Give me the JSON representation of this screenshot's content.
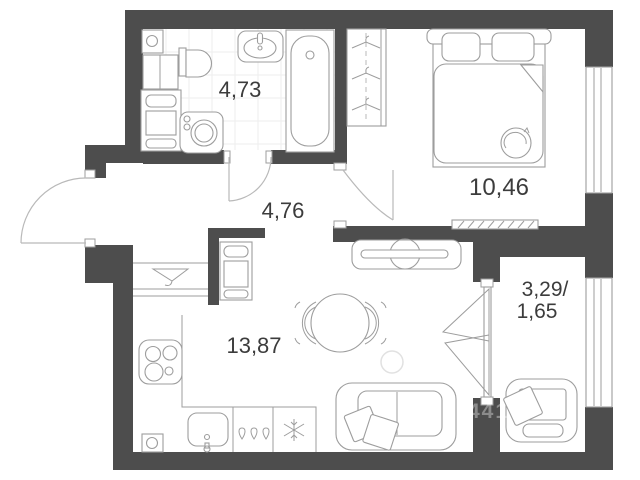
{
  "rooms": {
    "bathroom": {
      "area": "4,73"
    },
    "hallway": {
      "area": "4,76"
    },
    "bedroom": {
      "area": "10,46"
    },
    "living_kitchen": {
      "area": "13,87"
    },
    "balcony": {
      "area_total": "3,29/",
      "area_reduced": "1,65"
    }
  },
  "watermark": {
    "digits": "441"
  },
  "colors": {
    "wall": "#4d4d4d",
    "outline": "#9d9d9d",
    "outline_light": "#b9b9b9",
    "tile": "#ededed",
    "label": "#3c3c3c",
    "floor": "#ffffff"
  }
}
